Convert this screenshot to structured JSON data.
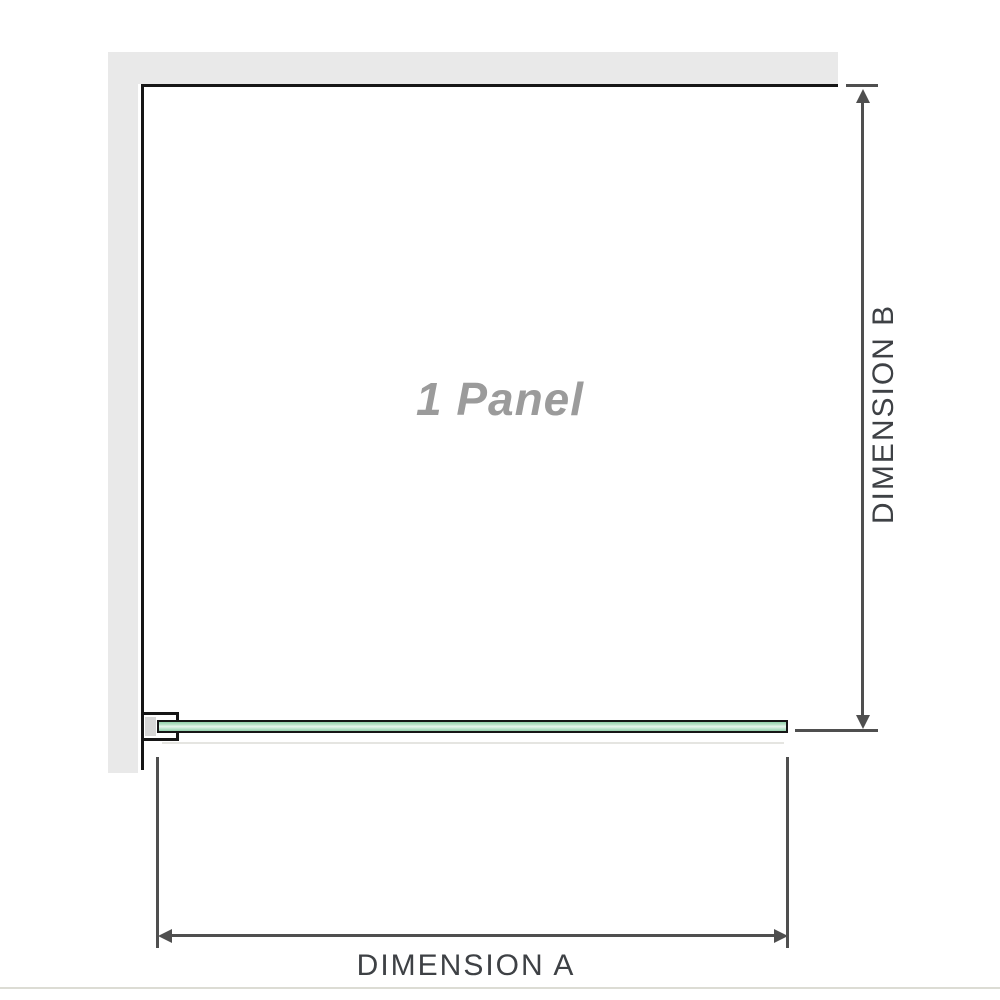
{
  "diagram": {
    "panel_label": "1 Panel",
    "dimensions": {
      "a_label": "DIMENSION A",
      "b_label": "DIMENSION B"
    },
    "colors": {
      "wall": "#e9e9e9",
      "outline": "#161616",
      "dimension_line": "#4f4f4f",
      "dimension_text": "#3e4145",
      "panel_text": "#9b9b9b",
      "bracket_fill": "#d6d6d6",
      "glass_edge_green": "#93d1ab",
      "glass_center_green": "#e9f6ee"
    }
  }
}
